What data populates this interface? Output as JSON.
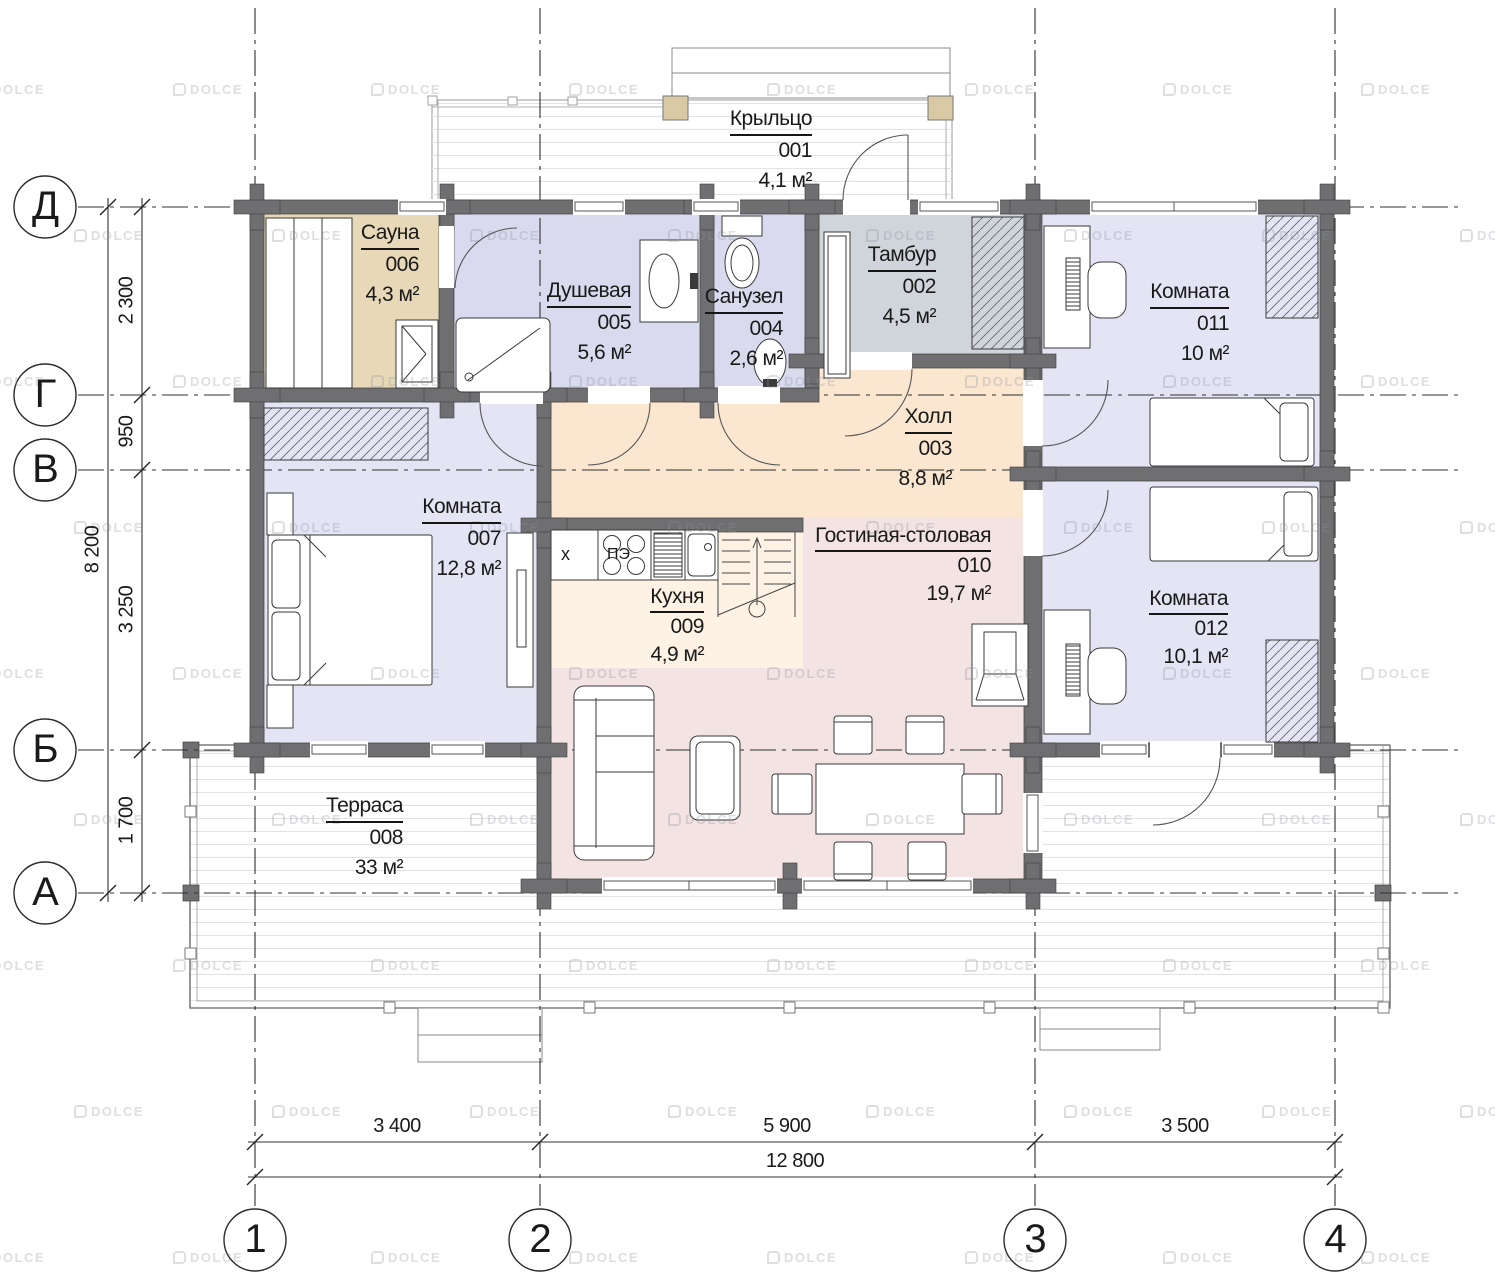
{
  "title": "План 1 этажа",
  "watermark": {
    "text": "DOLCE"
  },
  "axes": {
    "rows": [
      {
        "label": "Д"
      },
      {
        "label": "Г"
      },
      {
        "label": "В"
      },
      {
        "label": "Б"
      },
      {
        "label": "А"
      }
    ],
    "cols": [
      {
        "label": "1"
      },
      {
        "label": "2"
      },
      {
        "label": "3"
      },
      {
        "label": "4"
      }
    ]
  },
  "dimensions": {
    "left": {
      "segments": [
        "2 300",
        "950",
        "3 250",
        "1 700"
      ],
      "total": "8 200"
    },
    "bottom": {
      "segments": [
        "3 400",
        "5 900",
        "3 500"
      ],
      "total": "12 800"
    }
  },
  "rooms": [
    {
      "name": "Крыльцо",
      "number": "001",
      "area": "4,1 м²"
    },
    {
      "name": "Тамбур",
      "number": "002",
      "area": "4,5 м²"
    },
    {
      "name": "Холл",
      "number": "003",
      "area": "8,8 м²"
    },
    {
      "name": "Санузел",
      "number": "004",
      "area": "2,6 м²"
    },
    {
      "name": "Душевая",
      "number": "005",
      "area": "5,6 м²"
    },
    {
      "name": "Сауна",
      "number": "006",
      "area": "4,3 м²"
    },
    {
      "name": "Комната",
      "number": "007",
      "area": "12,8 м²"
    },
    {
      "name": "Терраса",
      "number": "008",
      "area": "33 м²"
    },
    {
      "name": "Кухня",
      "number": "009",
      "area": "4,9 м²"
    },
    {
      "name": "Гостиная-столовая",
      "number": "010",
      "area": "19,7 м²"
    },
    {
      "name": "Комната",
      "number": "011",
      "area": "10 м²"
    },
    {
      "name": "Комната",
      "number": "012",
      "area": "10,1 м²"
    }
  ],
  "kitchen": {
    "fridge_label": "х",
    "stove_label": "ПЭ"
  },
  "colors": {
    "wall": "#6f6f71",
    "bedroom_floor": "#e4e4f4",
    "bath_floor": "#d9daee",
    "sauna_floor": "#e7d8b8",
    "tambour_floor": "#cfd5da",
    "hall_floor": "#fbe6d0",
    "kitchen_floor": "#fdf2e3",
    "living_floor": "#f3e3e2",
    "porch_post": "#d9c9a4"
  }
}
